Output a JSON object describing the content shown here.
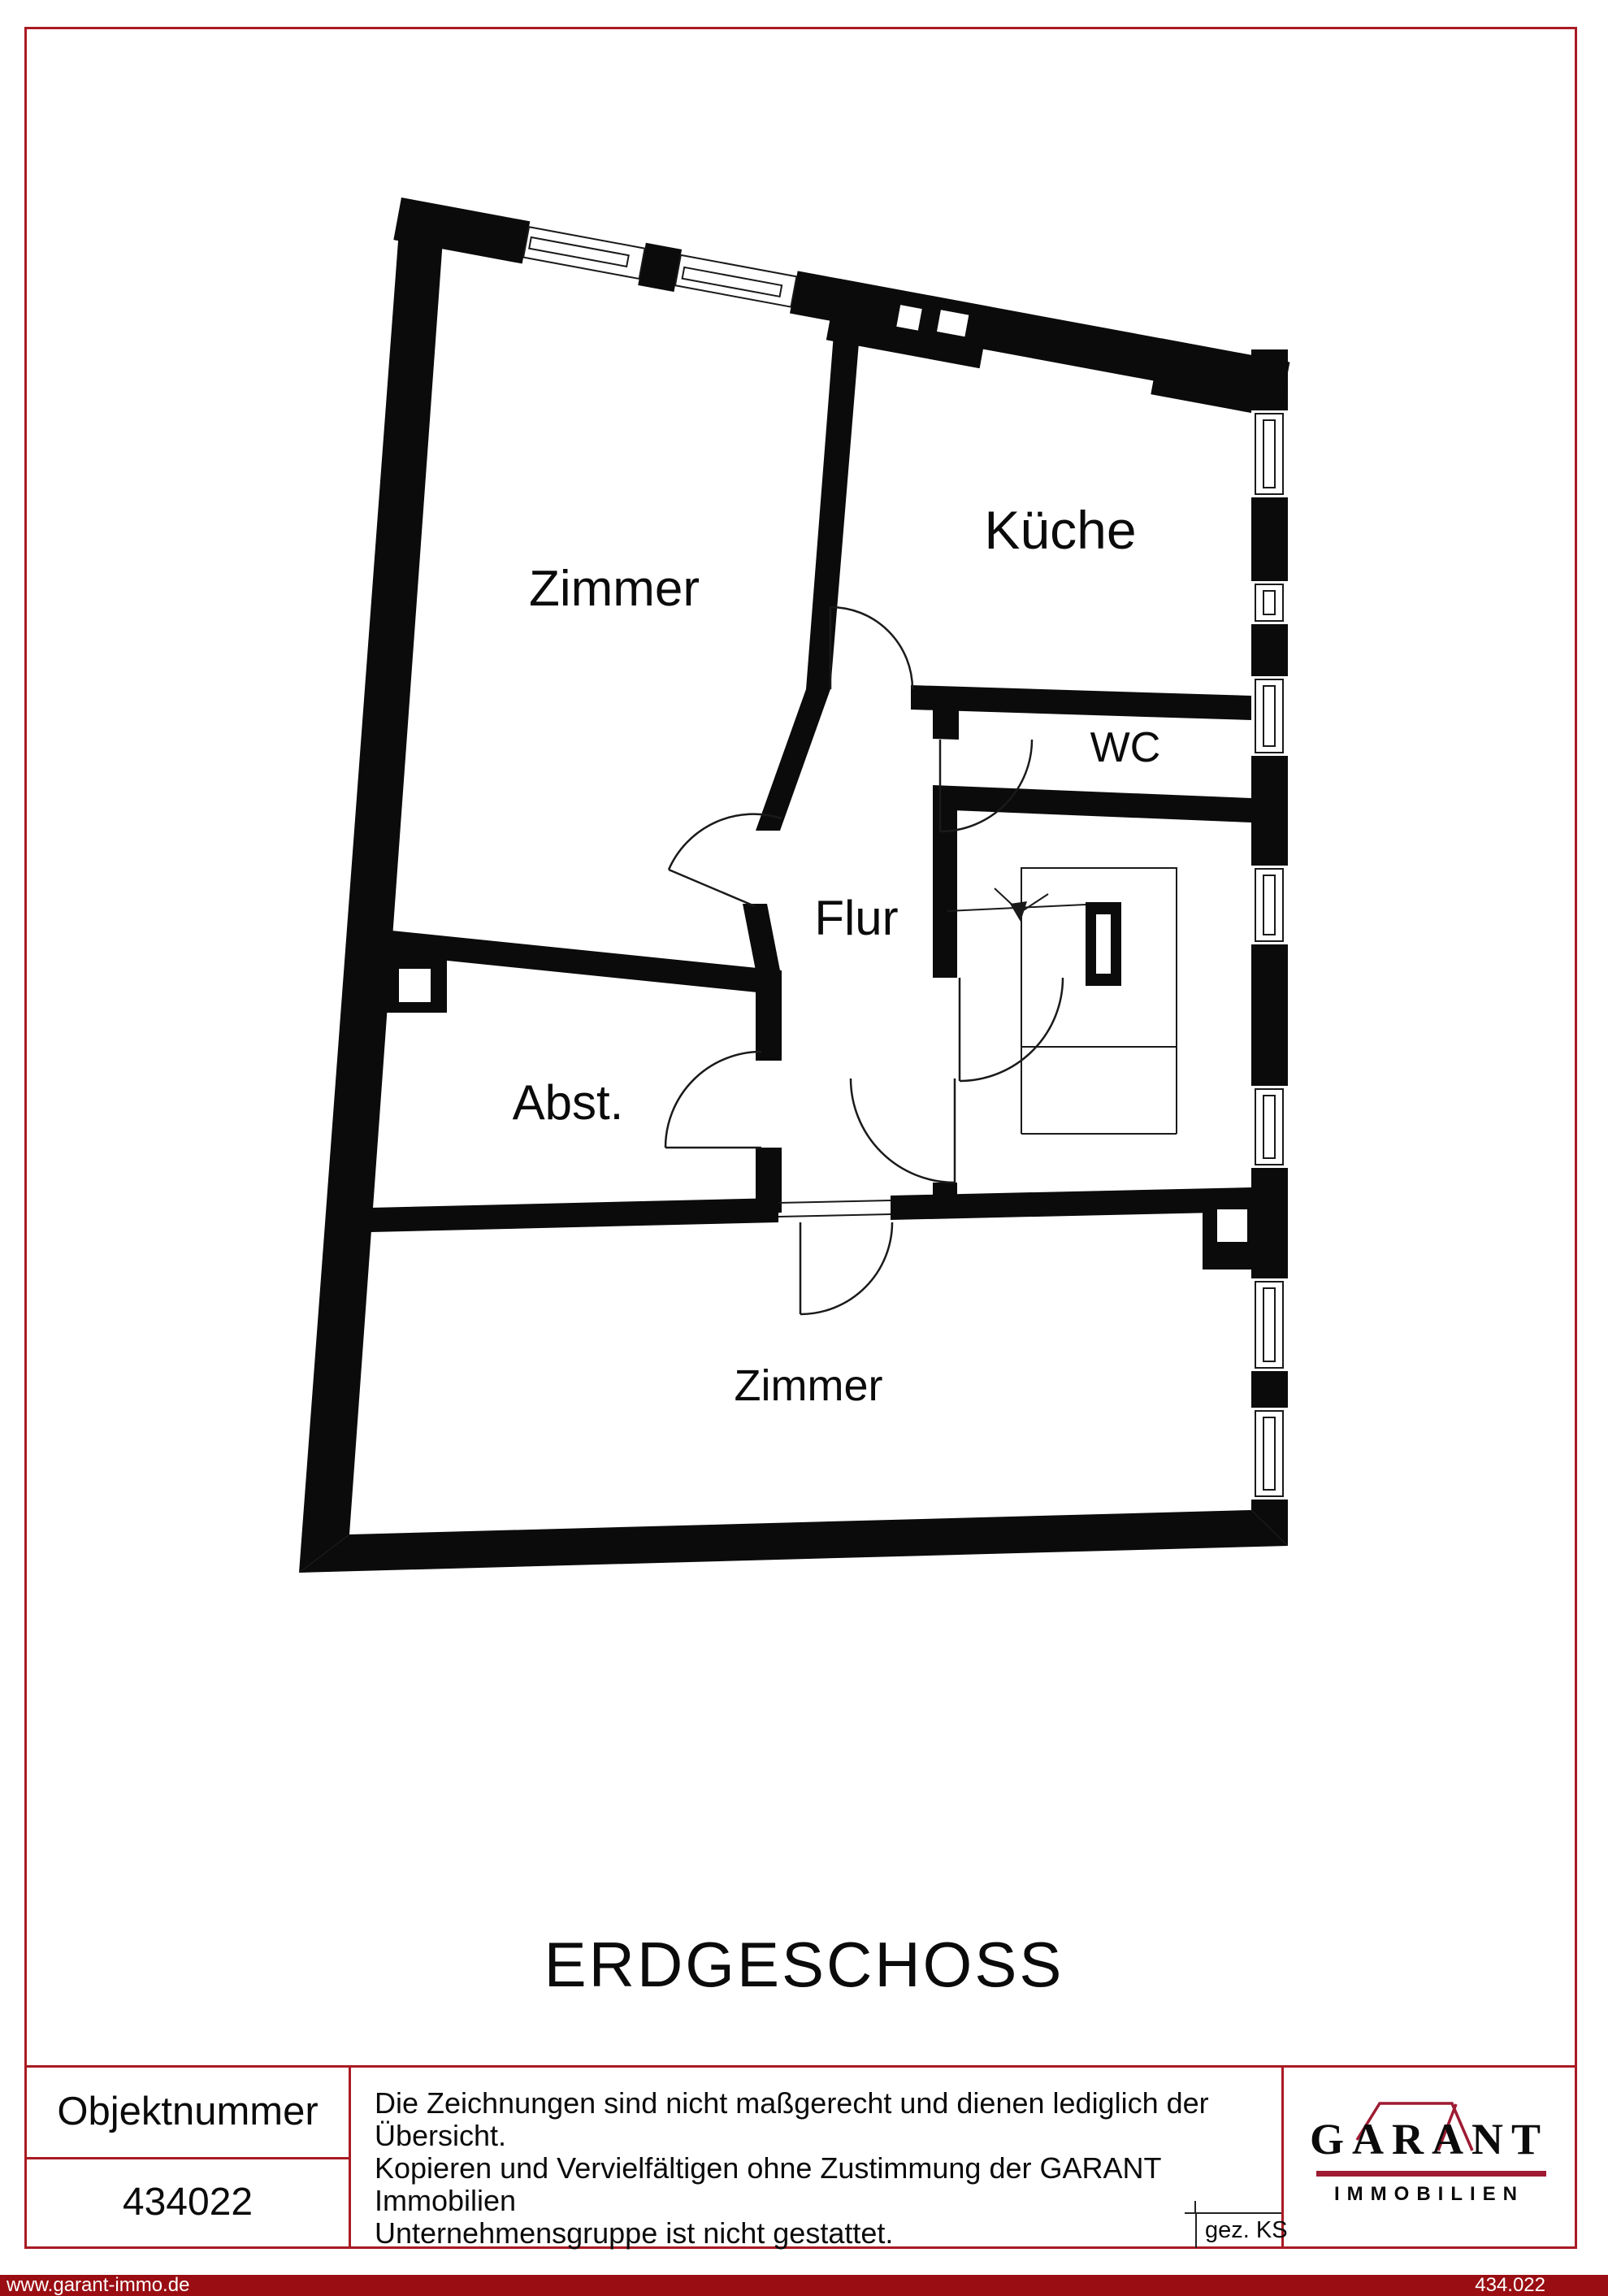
{
  "plan": {
    "title": "ERDGESCHOSS",
    "rooms": [
      {
        "id": "zimmer-top",
        "label": "Zimmer"
      },
      {
        "id": "kueche",
        "label": "Küche"
      },
      {
        "id": "wc",
        "label": "WC"
      },
      {
        "id": "flur",
        "label": "Flur"
      },
      {
        "id": "abstellraum",
        "label": "Abst."
      },
      {
        "id": "zimmer-bottom",
        "label": "Zimmer"
      }
    ]
  },
  "info_table": {
    "object_number_label": "Objektnummer",
    "object_number": "434022",
    "disclaimer_lines": [
      "Die Zeichnungen sind nicht maßgerecht und dienen lediglich der Übersicht.",
      "Kopieren und Vervielfältigen ohne Zustimmung der GARANT Immobilien",
      "Unternehmensgruppe ist nicht gestattet."
    ],
    "drawn_by_label": "gez. KS"
  },
  "logo": {
    "brand": "GARANT",
    "division": "IMMOBILIEN"
  },
  "footer": {
    "website": "www.garant-immo.de",
    "plan_number": "434.022"
  },
  "colors": {
    "accent_red": "#A91B23",
    "footer_red": "#9A0E13",
    "logo_red": "#9E1B32",
    "wall_black": "#0B0B0B"
  }
}
